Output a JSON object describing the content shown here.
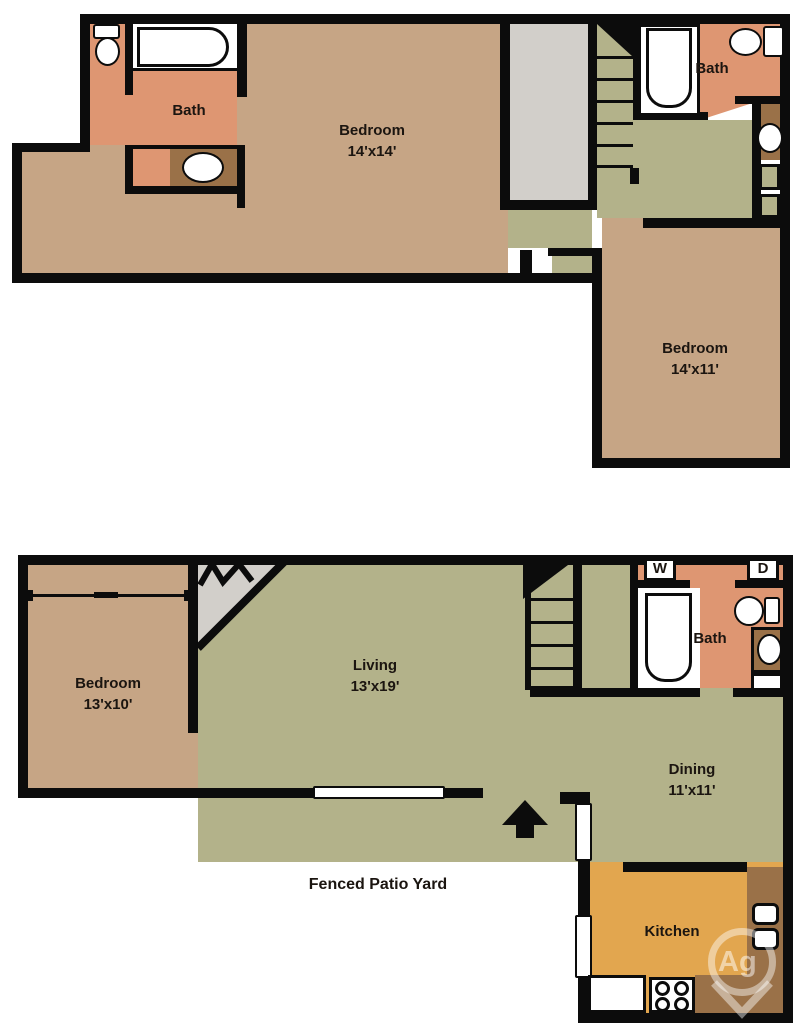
{
  "plan": {
    "upper_floor": {
      "bath_front_label": "Bath",
      "bedroom_main": {
        "name": "Bedroom",
        "dims": "14'x14'"
      },
      "bath_rear_label": "Bath",
      "bedroom_second": {
        "name": "Bedroom",
        "dims": "14'x11'"
      }
    },
    "lower_floor": {
      "bedroom": {
        "name": "Bedroom",
        "dims": "13'x10'"
      },
      "living": {
        "name": "Living",
        "dims": "13'x19'"
      },
      "bath_label": "Bath",
      "washer_label": "W",
      "dryer_label": "D",
      "dining": {
        "name": "Dining",
        "dims": "11'x11'"
      },
      "kitchen_label": "Kitchen",
      "patio_label": "Fenced Patio Yard"
    },
    "watermark": "Ag",
    "colors": {
      "wall": "#0c0c0c",
      "bedroom_tan": "#c6a585",
      "living_green": "#b3b28a",
      "bath_salmon": "#de9672",
      "counter_brown": "#9a7148",
      "kitchen_orange": "#e2a64f",
      "closet_gray": "#d2cfca"
    }
  }
}
